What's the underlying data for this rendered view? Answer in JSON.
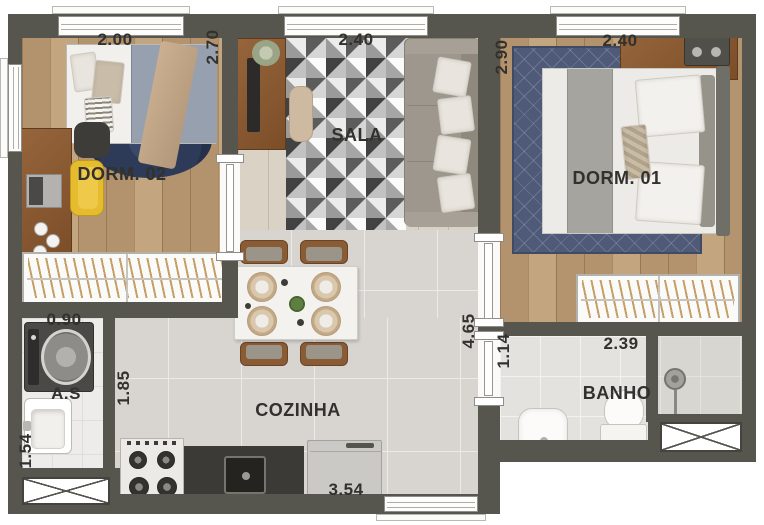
{
  "plan_title": "Apartment floor plan (2 dormitories)",
  "rooms": {
    "dorm02": {
      "name": "DORM. 02",
      "dim_top": "2.00",
      "dim_right": "2.70"
    },
    "sala": {
      "name": "SALA",
      "dim_top": "2.40"
    },
    "dorm01": {
      "name": "DORM. 01",
      "dim_top": "2.40",
      "dim_left": "2.90"
    },
    "as": {
      "name": "A.S",
      "dim_top": "0.90",
      "dim_left": "1.54",
      "dim_right": "1.85"
    },
    "cozinha": {
      "name": "COZINHA",
      "dim_bottom": "3.54",
      "dim_right": "4.65"
    },
    "banho": {
      "name": "BANHO",
      "dim_top": "2.39",
      "dim_left": "1.14"
    }
  },
  "colors": {
    "wall": "#57564e",
    "wood_floor": "#bfa17c",
    "tile_floor": "#d8d5d1",
    "rug_dorm02": "#2d3a58",
    "rug_dorm01": "#4e5a77",
    "yellow_chair": "#e6bc2f",
    "sofa": "#9d978d",
    "furniture_wood": "#8a5b35"
  }
}
